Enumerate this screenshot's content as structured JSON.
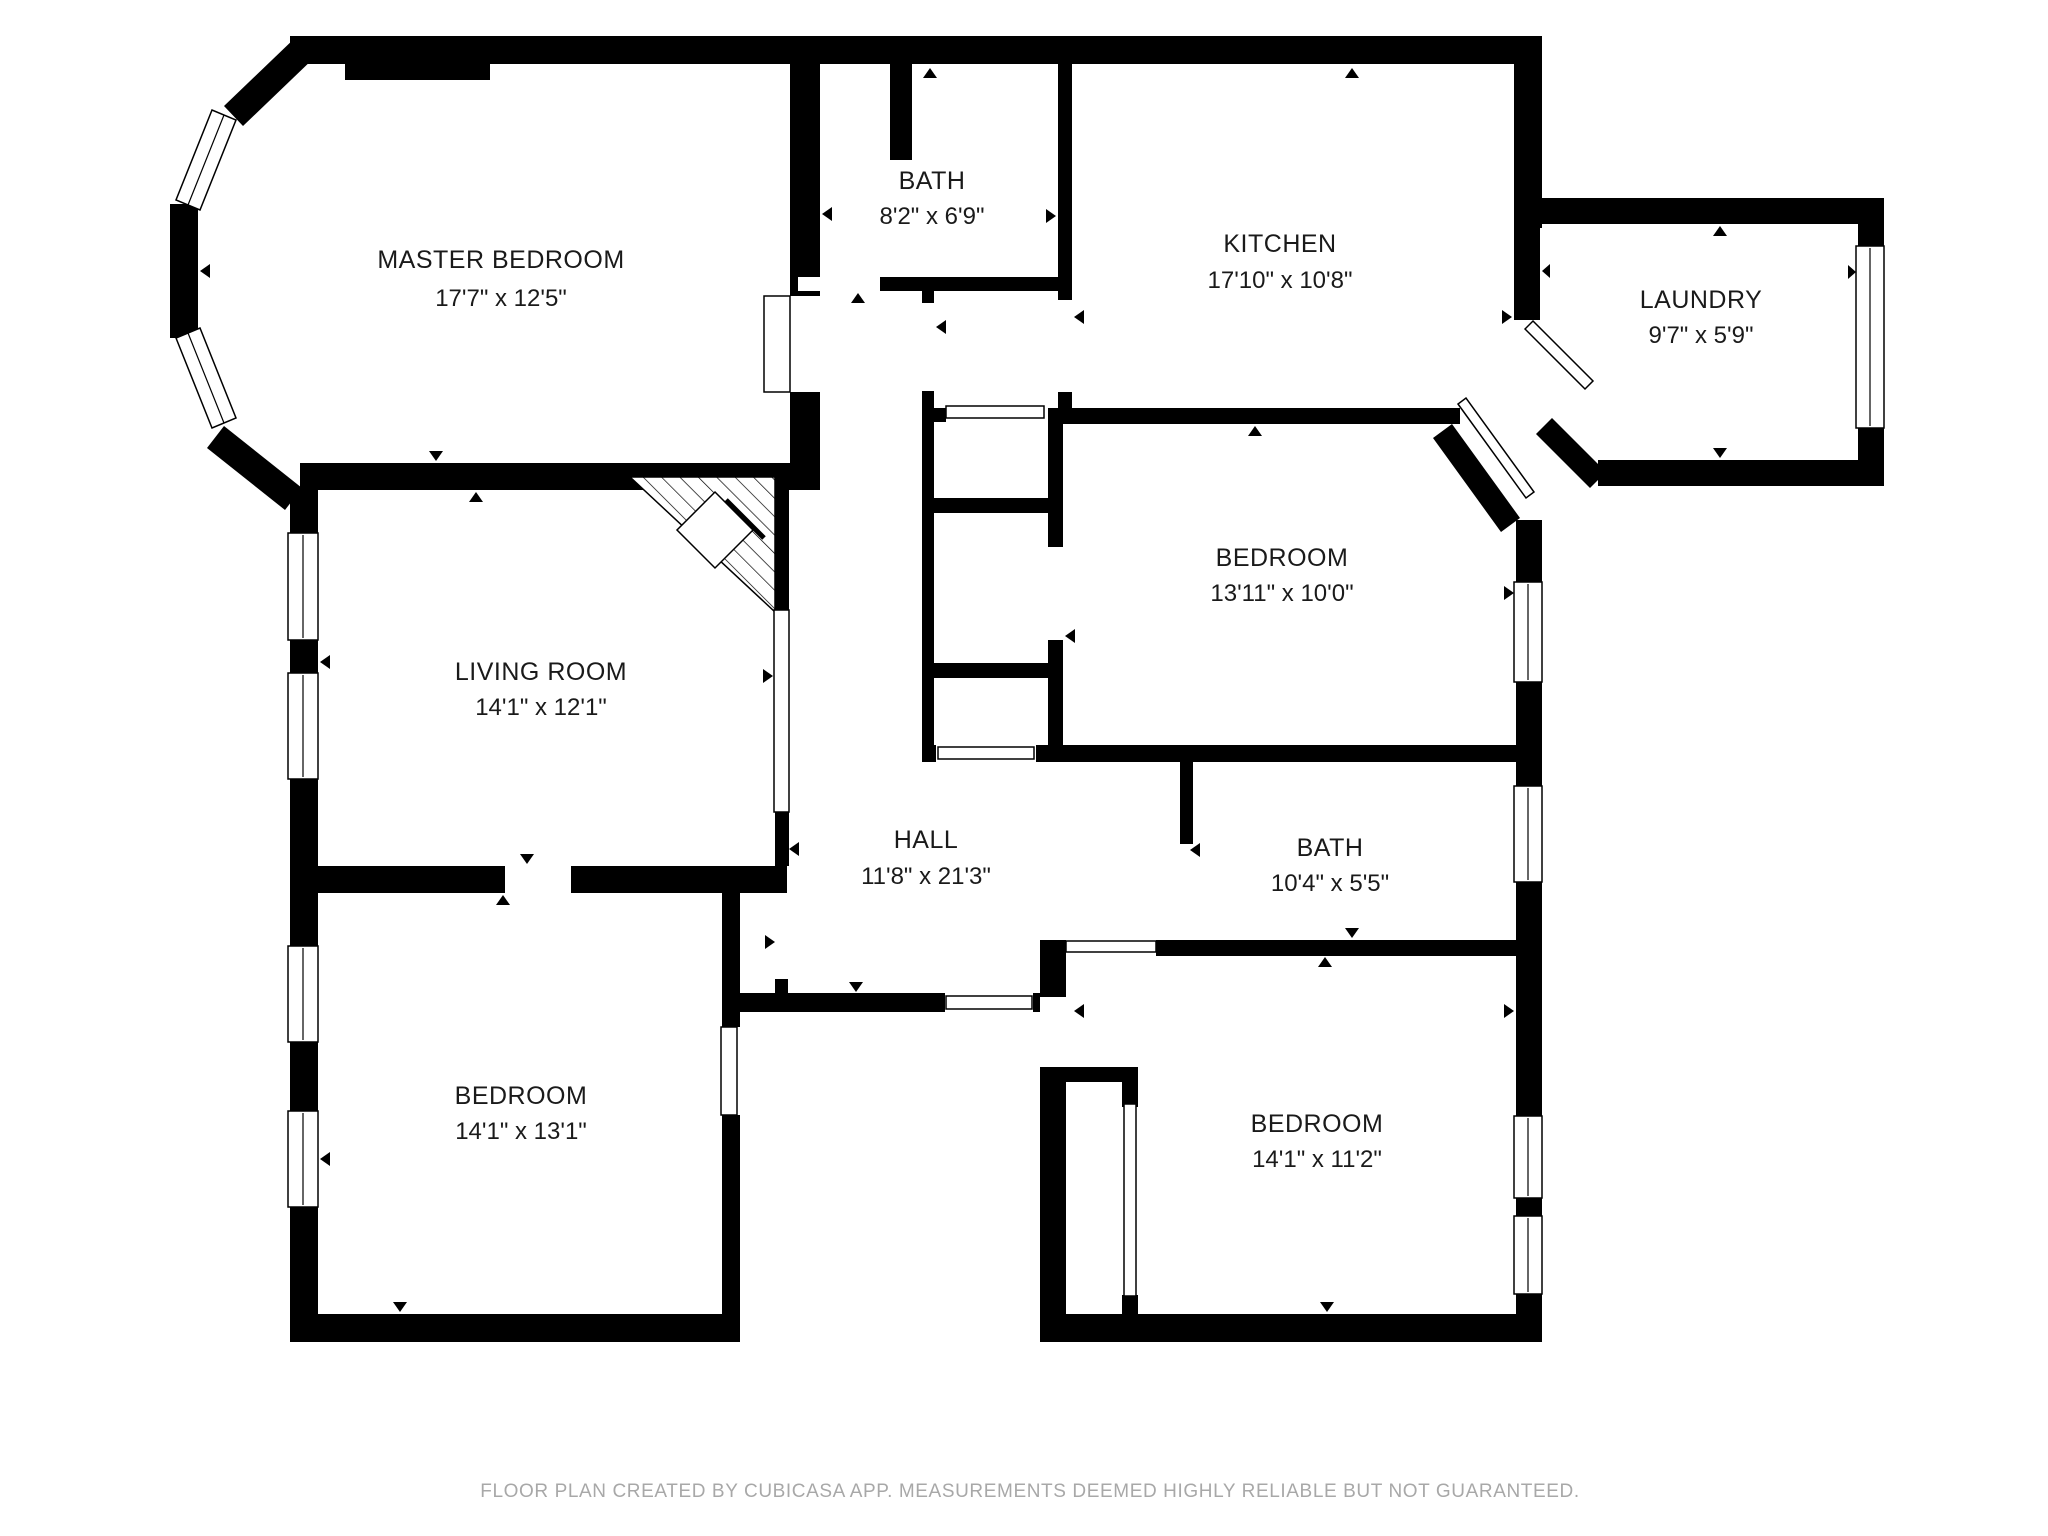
{
  "footer": {
    "text": "FLOOR PLAN CREATED BY CUBICASA APP. MEASUREMENTS DEEMED HIGHLY RELIABLE BUT NOT GUARANTEED."
  },
  "colors": {
    "wall": "#000000",
    "floor": "#ffffff",
    "label": "#1a1a1a",
    "footer": "#a8a8a8"
  },
  "rooms": [
    {
      "id": "master-bedroom",
      "name": "MASTER BEDROOM",
      "dimensions": "17'7\" x 12'5\""
    },
    {
      "id": "bath-top",
      "name": "BATH",
      "dimensions": "8'2\" x 6'9\""
    },
    {
      "id": "kitchen",
      "name": "KITCHEN",
      "dimensions": "17'10\" x 10'8\""
    },
    {
      "id": "laundry",
      "name": "LAUNDRY",
      "dimensions": "9'7\" x 5'9\""
    },
    {
      "id": "bedroom-right",
      "name": "BEDROOM",
      "dimensions": "13'11\" x 10'0\""
    },
    {
      "id": "living-room",
      "name": "LIVING ROOM",
      "dimensions": "14'1\" x 12'1\""
    },
    {
      "id": "hall",
      "name": "HALL",
      "dimensions": "11'8\" x 21'3\""
    },
    {
      "id": "bath-middle",
      "name": "BATH",
      "dimensions": "10'4\" x 5'5\""
    },
    {
      "id": "bedroom-bottom-left",
      "name": "BEDROOM",
      "dimensions": "14'1\" x 13'1\""
    },
    {
      "id": "bedroom-bottom-right",
      "name": "BEDROOM",
      "dimensions": "14'1\" x 11'2\""
    }
  ]
}
